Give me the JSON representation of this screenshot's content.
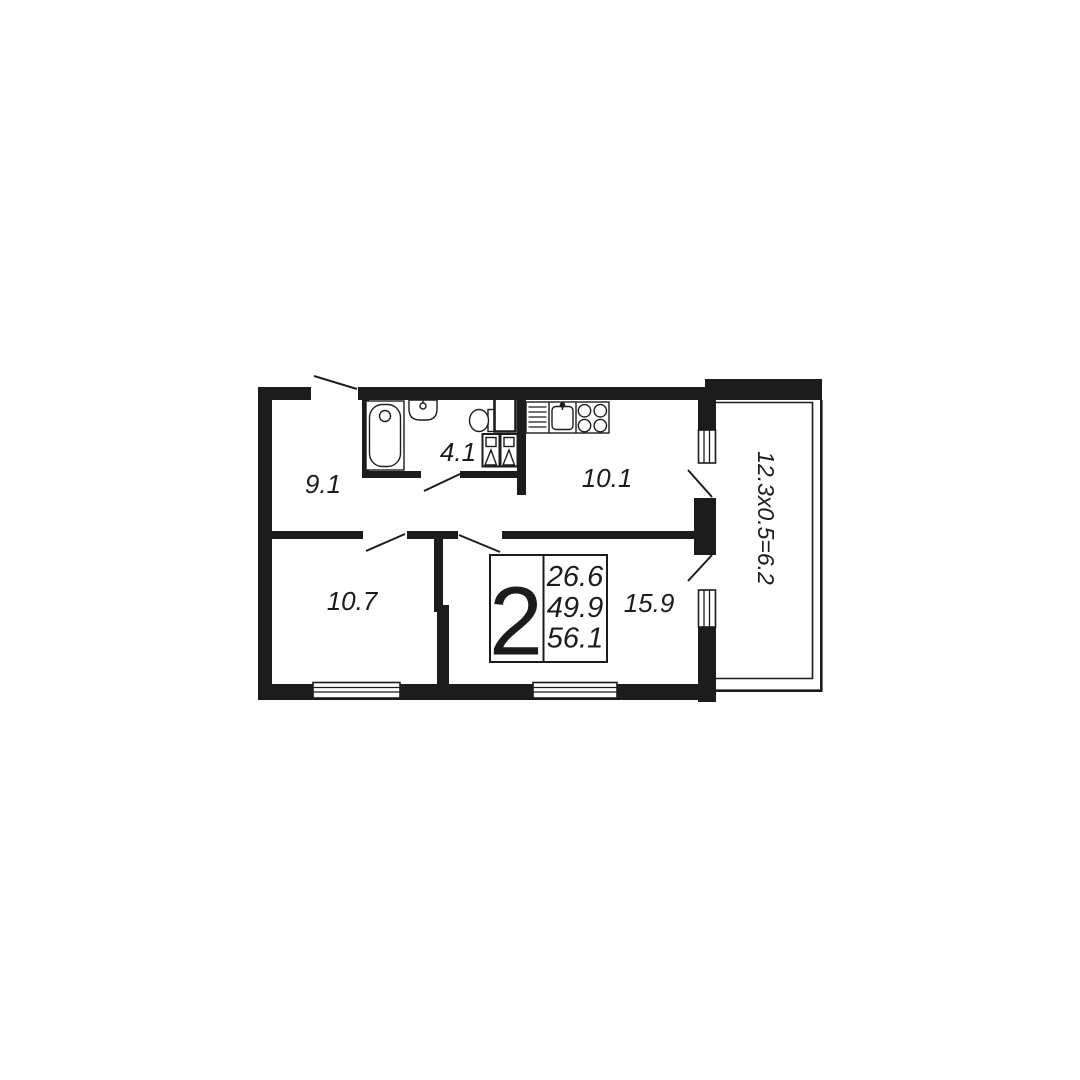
{
  "plan": {
    "background": "#ffffff",
    "wall_color": "#1c1c1c"
  },
  "rooms": {
    "hallway": {
      "area": "9.1"
    },
    "bathroom": {
      "area": "4.1"
    },
    "kitchen": {
      "area": "10.1"
    },
    "bedroom": {
      "area": "10.7"
    },
    "living_room": {
      "area": "15.9"
    }
  },
  "info_box": {
    "room_count": "2",
    "area_line1": "26.6",
    "area_line2": "49.9",
    "area_line3": "56.1"
  },
  "balcony": {
    "dimension": "12.3x0.5=6.2"
  }
}
